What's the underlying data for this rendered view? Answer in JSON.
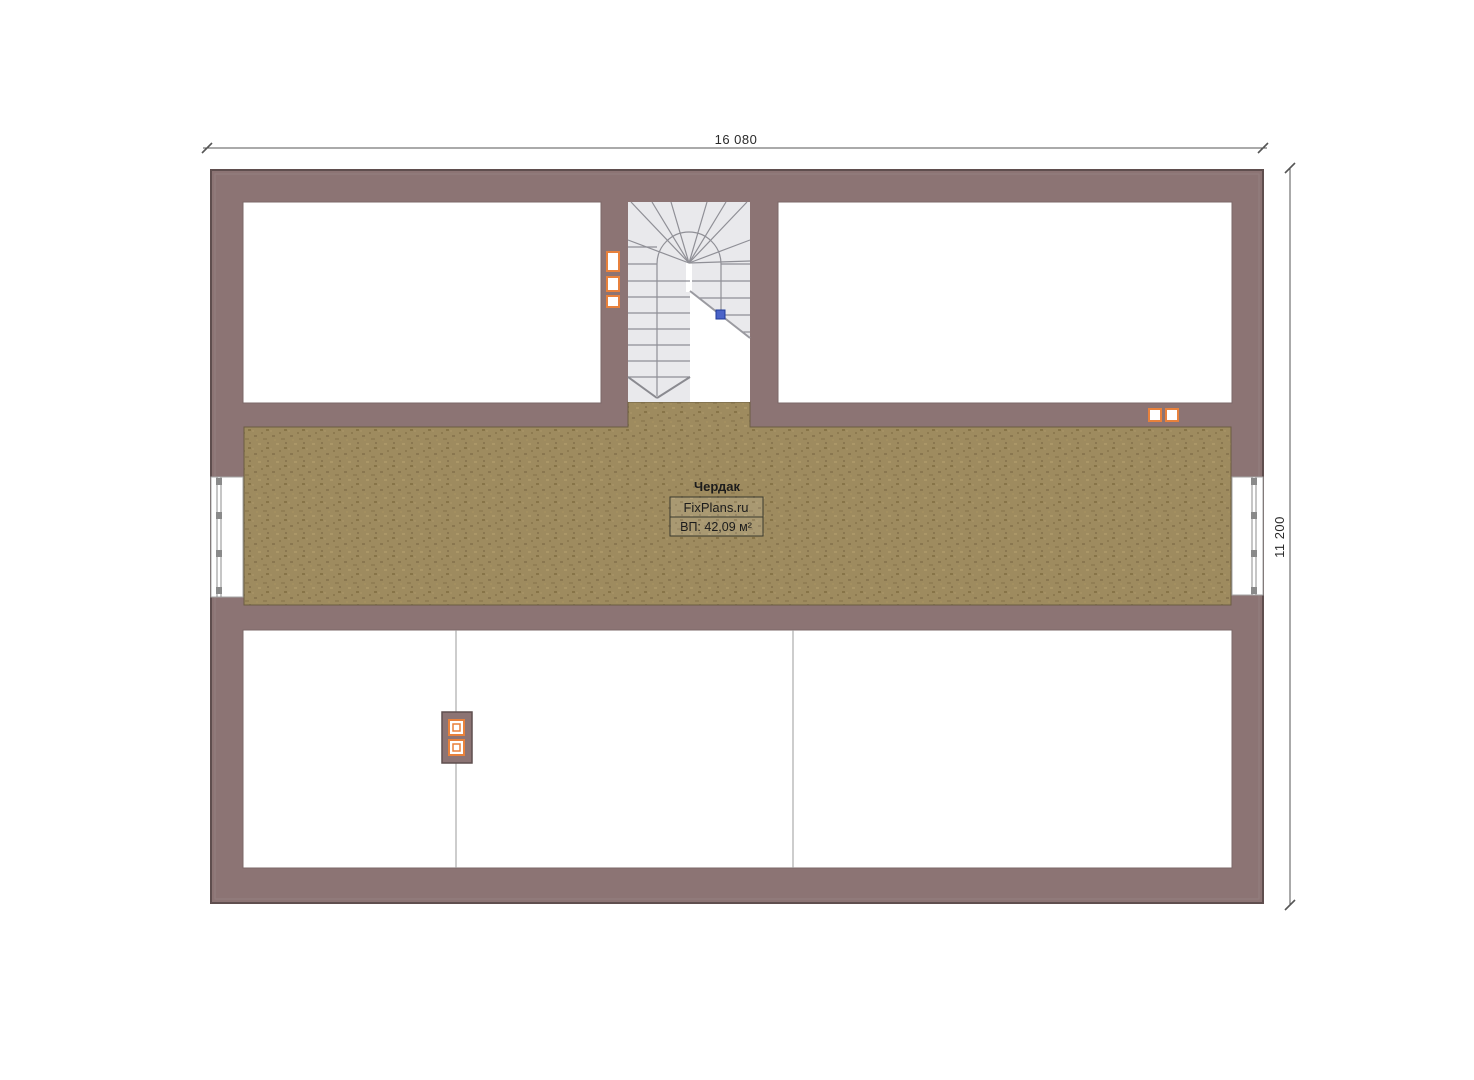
{
  "plan": {
    "room_label": {
      "title": "Чердак",
      "brand": "FixPlans.ru",
      "area": "ВП: 42,09 м²"
    },
    "dimensions": {
      "horizontal": "16 080",
      "vertical": "11 200"
    },
    "colors": {
      "wall": "#8c7474",
      "wall_outline": "#5f4e4e",
      "wall_bevel": "#9b8888",
      "attic_floor": "#9e8b5f",
      "attic_floor_speckle": "#8a7750",
      "stair_fill": "#e9e9ec",
      "stair_line": "#8f8f96",
      "socket_orange": "#e8813c",
      "section_marker_blue": "#4a63c8",
      "dimension_line": "#555555",
      "window_frame": "#8c8c8c",
      "partition_line": "#9b9b9b"
    },
    "icons": [
      "power-outlet-icon",
      "chimney-vent-icon",
      "stair-section-marker-icon",
      "window-mullion-icon"
    ]
  }
}
